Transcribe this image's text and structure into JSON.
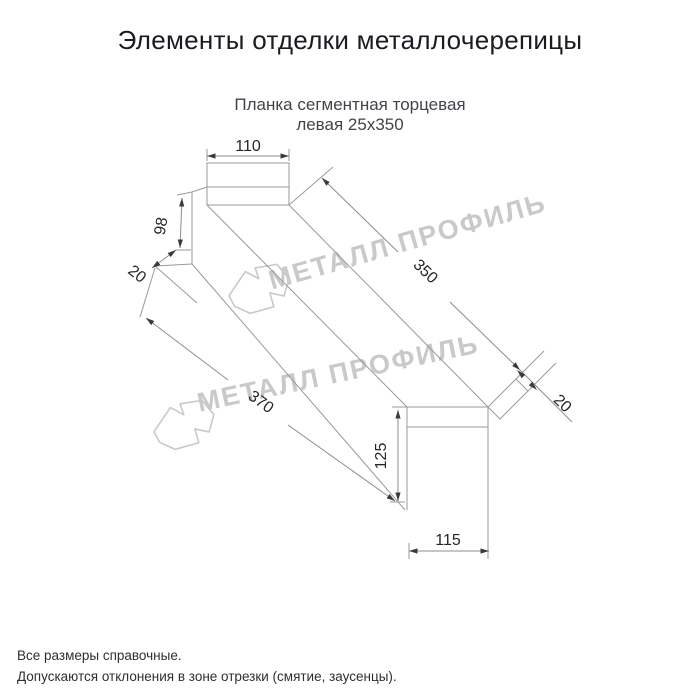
{
  "header": {
    "title": "Элементы отделки металлочерепицы"
  },
  "product": {
    "subtitle_line1": "Планка сегментная торцевая",
    "subtitle_line2": "левая 25х350"
  },
  "drawing": {
    "type": "axonometric technical drawing of left segmental end strip",
    "dimensions": {
      "top_width": "110",
      "left_height": "98",
      "left_flange": "20",
      "length_top": "350",
      "right_flange": "20",
      "length_bottom": "370",
      "right_height": "125",
      "bottom_width": "115"
    }
  },
  "watermark": {
    "text": "МЕТАЛЛ ПРОФИЛЬ"
  },
  "footer": {
    "note1": "Все размеры справочные.",
    "note2": "Допускаются отклонения в зоне отрезки (смятие, заусенцы)."
  },
  "colors": {
    "background": "#ffffff",
    "title_text": "#1b1b22",
    "subtitle_text": "#43434d",
    "line": "#9a9a9a",
    "dimension_text": "#26262b",
    "watermark": "#c9c9c9"
  }
}
